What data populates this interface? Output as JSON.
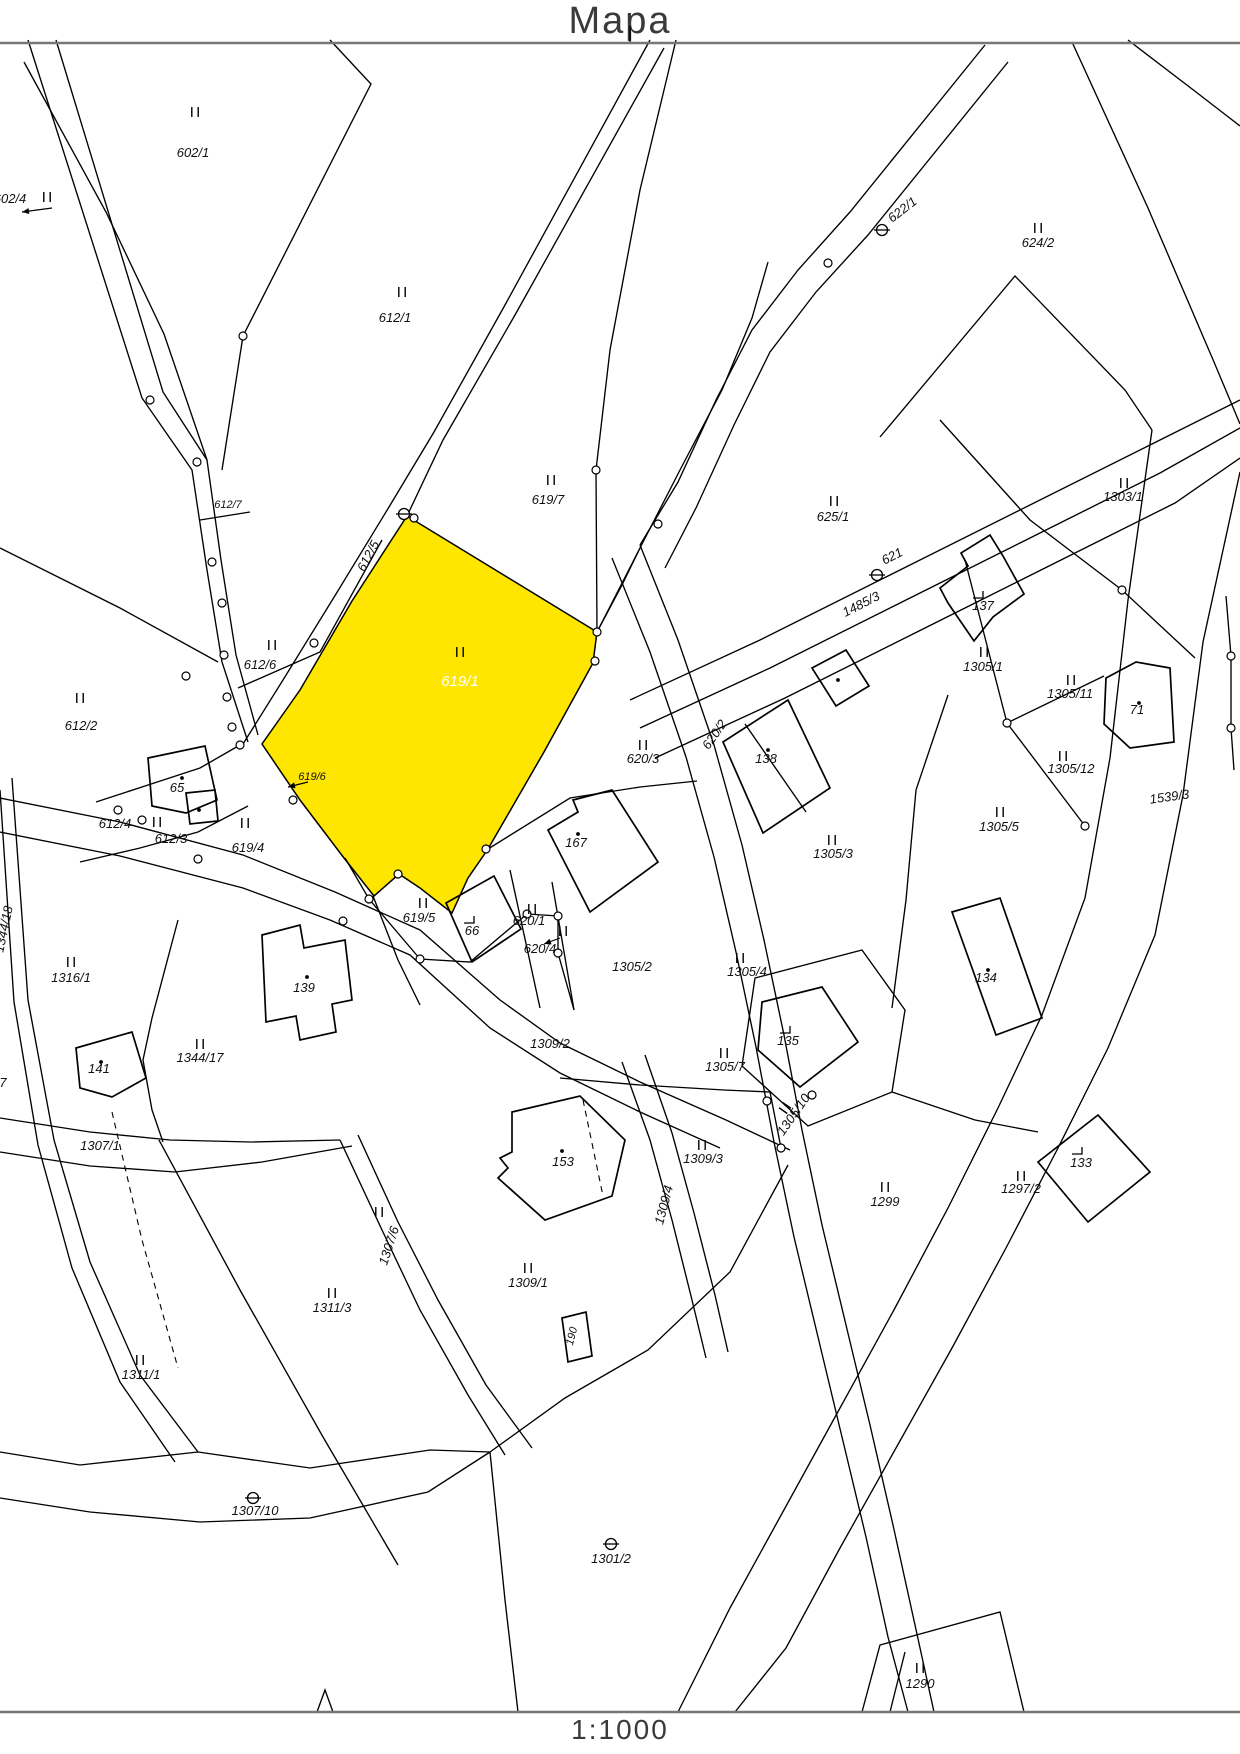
{
  "title": "Mapa",
  "scale": "1:1000",
  "map": {
    "width": 1240,
    "height": 1754,
    "highlighted_parcel": "619/1",
    "colors": {
      "highlight": "#ffe600",
      "line": "#000000",
      "rule": "#777777",
      "label": "#111111"
    },
    "highlight_points": "407,516 597,632 593,663 544,752 488,849 468,878 452,913 420,888 399,874 374,896 344,858 300,800 262,744 300,690 352,601",
    "labels": [
      {
        "t": "602/4",
        "x": 10,
        "y": 203
      },
      {
        "t": "602/1",
        "x": 193,
        "y": 157
      },
      {
        "t": "612/1",
        "x": 395,
        "y": 322
      },
      {
        "t": "622/1",
        "x": 905,
        "y": 213,
        "r": -38
      },
      {
        "t": "624/2",
        "x": 1038,
        "y": 247
      },
      {
        "t": "612/7",
        "x": 228,
        "y": 508,
        "s": 11
      },
      {
        "t": "619/7",
        "x": 548,
        "y": 504
      },
      {
        "t": "625/1",
        "x": 833,
        "y": 521
      },
      {
        "t": "1303/1",
        "x": 1123,
        "y": 501
      },
      {
        "t": "612/5",
        "x": 372,
        "y": 558,
        "r": -62
      },
      {
        "t": "619/1",
        "x": 460,
        "y": 686,
        "s": 15,
        "c": "#ffffff"
      },
      {
        "t": "621",
        "x": 894,
        "y": 560,
        "r": -27
      },
      {
        "t": "1485/3",
        "x": 863,
        "y": 608,
        "r": -27
      },
      {
        "t": "137",
        "x": 983,
        "y": 610
      },
      {
        "t": "1305/1",
        "x": 983,
        "y": 671
      },
      {
        "t": "1305/11",
        "x": 1070,
        "y": 698
      },
      {
        "t": "71",
        "x": 1137,
        "y": 714
      },
      {
        "t": "612/6",
        "x": 260,
        "y": 669
      },
      {
        "t": "612/2",
        "x": 81,
        "y": 730
      },
      {
        "t": "620/3",
        "x": 643,
        "y": 763
      },
      {
        "t": "620/2",
        "x": 718,
        "y": 737,
        "r": -55
      },
      {
        "t": "138",
        "x": 766,
        "y": 763
      },
      {
        "t": "1305/12",
        "x": 1071,
        "y": 773
      },
      {
        "t": "1539/3",
        "x": 1170,
        "y": 801,
        "r": -8
      },
      {
        "t": "65",
        "x": 177,
        "y": 792
      },
      {
        "t": "619/6",
        "x": 312,
        "y": 780,
        "s": 11
      },
      {
        "t": "612/4",
        "x": 115,
        "y": 828
      },
      {
        "t": "612/3",
        "x": 171,
        "y": 843
      },
      {
        "t": "619/4",
        "x": 248,
        "y": 852
      },
      {
        "t": "167",
        "x": 576,
        "y": 847
      },
      {
        "t": "1305/3",
        "x": 833,
        "y": 858
      },
      {
        "t": "1305/5",
        "x": 999,
        "y": 831
      },
      {
        "t": "1316/1",
        "x": 71,
        "y": 982
      },
      {
        "t": "619/5",
        "x": 419,
        "y": 922
      },
      {
        "t": "66",
        "x": 472,
        "y": 935
      },
      {
        "t": "620/1",
        "x": 529,
        "y": 925
      },
      {
        "t": "620/4",
        "x": 540,
        "y": 953
      },
      {
        "t": "1305/2",
        "x": 632,
        "y": 971
      },
      {
        "t": "1305/4",
        "x": 747,
        "y": 976
      },
      {
        "t": "139",
        "x": 304,
        "y": 992
      },
      {
        "t": "134",
        "x": 986,
        "y": 982
      },
      {
        "t": "1344/17",
        "x": 200,
        "y": 1062
      },
      {
        "t": "141",
        "x": 99,
        "y": 1073
      },
      {
        "t": "1344/18",
        "x": 8,
        "y": 930,
        "r": -78
      },
      {
        "t": "1307/1",
        "x": 100,
        "y": 1150
      },
      {
        "t": "1309/2",
        "x": 550,
        "y": 1048
      },
      {
        "t": "1305/7",
        "x": 725,
        "y": 1071
      },
      {
        "t": "135",
        "x": 788,
        "y": 1045
      },
      {
        "t": "1305/10",
        "x": 797,
        "y": 1117,
        "r": -55
      },
      {
        "t": "153",
        "x": 563,
        "y": 1166
      },
      {
        "t": "1309/3",
        "x": 703,
        "y": 1163
      },
      {
        "t": "133",
        "x": 1081,
        "y": 1167
      },
      {
        "t": "1297/2",
        "x": 1021,
        "y": 1193
      },
      {
        "t": "1299",
        "x": 885,
        "y": 1206
      },
      {
        "t": "1307/6",
        "x": 393,
        "y": 1247,
        "r": -72
      },
      {
        "t": "1309/4",
        "x": 668,
        "y": 1206,
        "r": -75
      },
      {
        "t": "1309/1",
        "x": 528,
        "y": 1287
      },
      {
        "t": "1311/3",
        "x": 332,
        "y": 1312
      },
      {
        "t": "1311/1",
        "x": 141,
        "y": 1379
      },
      {
        "t": "190",
        "x": 575,
        "y": 1337,
        "r": -75,
        "s": 11
      },
      {
        "t": "1307/10",
        "x": 255,
        "y": 1515
      },
      {
        "t": "1301/2",
        "x": 611,
        "y": 1563
      },
      {
        "t": "1290",
        "x": 920,
        "y": 1688
      },
      {
        "t": "7",
        "x": 3,
        "y": 1087
      }
    ],
    "landuse_marks": [
      {
        "x": 195,
        "y": 112
      },
      {
        "x": 47,
        "y": 197
      },
      {
        "x": 402,
        "y": 292
      },
      {
        "x": 1038,
        "y": 228
      },
      {
        "x": 551,
        "y": 480
      },
      {
        "x": 834,
        "y": 501
      },
      {
        "x": 1124,
        "y": 483
      },
      {
        "x": 272,
        "y": 645
      },
      {
        "x": 80,
        "y": 698
      },
      {
        "x": 460,
        "y": 652
      },
      {
        "x": 643,
        "y": 745
      },
      {
        "x": 984,
        "y": 652
      },
      {
        "x": 1071,
        "y": 680
      },
      {
        "x": 1063,
        "y": 756
      },
      {
        "x": 157,
        "y": 822
      },
      {
        "x": 245,
        "y": 823
      },
      {
        "x": 832,
        "y": 840
      },
      {
        "x": 1000,
        "y": 812
      },
      {
        "x": 71,
        "y": 962
      },
      {
        "x": 423,
        "y": 903
      },
      {
        "x": 532,
        "y": 909
      },
      {
        "x": 563,
        "y": 931
      },
      {
        "x": 740,
        "y": 958
      },
      {
        "x": 200,
        "y": 1044
      },
      {
        "x": 724,
        "y": 1053
      },
      {
        "x": 702,
        "y": 1145
      },
      {
        "x": 1021,
        "y": 1176
      },
      {
        "x": 885,
        "y": 1187
      },
      {
        "x": 528,
        "y": 1268
      },
      {
        "x": 332,
        "y": 1293
      },
      {
        "x": 140,
        "y": 1360
      },
      {
        "x": 379,
        "y": 1212
      },
      {
        "x": 920,
        "y": 1668
      },
      {
        "x": 785,
        "y": 1108,
        "r": -55
      }
    ],
    "survey_marks": [
      [
        404,
        514
      ],
      [
        882,
        230
      ],
      [
        877,
        575
      ],
      [
        253,
        1498
      ],
      [
        611,
        1544
      ]
    ],
    "boundary_points": [
      [
        150,
        400
      ],
      [
        197,
        462
      ],
      [
        212,
        562
      ],
      [
        224,
        655
      ],
      [
        243,
        336
      ],
      [
        596,
        470
      ],
      [
        658,
        524
      ],
      [
        597,
        632
      ],
      [
        595,
        661
      ],
      [
        486,
        849
      ],
      [
        398,
        874
      ],
      [
        369,
        899
      ],
      [
        420,
        959
      ],
      [
        527,
        914
      ],
      [
        558,
        916
      ],
      [
        558,
        953
      ],
      [
        343,
        921
      ],
      [
        198,
        859
      ],
      [
        222,
        603
      ],
      [
        227,
        697
      ],
      [
        232,
        727
      ],
      [
        240,
        745
      ],
      [
        293,
        800
      ],
      [
        314,
        643
      ],
      [
        186,
        676
      ],
      [
        828,
        263
      ],
      [
        1122,
        590
      ],
      [
        1231,
        656
      ],
      [
        1231,
        728
      ],
      [
        1007,
        723
      ],
      [
        1085,
        826
      ],
      [
        767,
        1101
      ],
      [
        812,
        1095
      ],
      [
        781,
        1148
      ],
      [
        118,
        810
      ],
      [
        142,
        820
      ],
      [
        414,
        518
      ]
    ],
    "building_dots": [
      [
        182,
        778
      ],
      [
        199,
        810
      ],
      [
        768,
        750
      ],
      [
        838,
        680
      ],
      [
        578,
        834
      ],
      [
        1139,
        703
      ],
      [
        307,
        977
      ],
      [
        101,
        1062
      ],
      [
        562,
        1151
      ],
      [
        988,
        970
      ]
    ],
    "building_marks": [
      [
        979,
        596
      ],
      [
        470,
        921
      ],
      [
        786,
        1031
      ],
      [
        1078,
        1152
      ]
    ],
    "arrows": [
      [
        52,
        208,
        22,
        212
      ],
      [
        308,
        782,
        288,
        787
      ],
      [
        560,
        938,
        544,
        944
      ]
    ],
    "lines": [
      "M630,26 L630,43",
      "M28,40 L142,398 L192,470 L207,570 L222,662 L248,742",
      "M56,40 L163,392 L207,460 L221,560 L236,655 L258,735",
      "M24,62 L106,212 L164,334 L207,460",
      "M330,40 L371,84 L243,336 L222,470",
      "M650,40 L505,305 L434,432 L389,507 L336,594 L283,680 L243,744",
      "M664,48 L515,315 L443,440 L407,516",
      "M676,40 L640,190 L610,350 L596,470 L597,632",
      "M597,632 L640,548 L680,470 L722,390 L752,318 L768,262",
      "M985,45 L850,212 L798,270 L752,330 L716,400 L678,482 L640,545",
      "M1008,62 L868,235 L816,292 L770,352 L734,425 L696,508 L665,568",
      "M640,545 L678,640 L714,745 L742,845 L764,940 L784,1035 L802,1130 L822,1225 L846,1325 L870,1425 L893,1525 L915,1625 L934,1712",
      "M612,558 L650,652 L686,757 L714,857 L736,952 L756,1047 L774,1142 L794,1237 L818,1337 L842,1437 L866,1537 L888,1637 L908,1712",
      "M597,632 L622,585 L640,548",
      "M630,700 L760,640 L890,575 L1020,510 L1150,445 L1240,400",
      "M640,728 L770,668 L900,603 L1030,538 L1160,473 L1240,428",
      "M655,758 L785,698 L915,633 L1045,568 L1175,503 L1240,458",
      "M1152,430 L1128,600 L1110,758 L1085,898 L1042,1015 L998,1108 L948,1208 L895,1308 L840,1408 L785,1508 L730,1608 L678,1712",
      "M1240,472 L1203,642 L1183,795 L1155,935 L1108,1048 L1058,1148 L1006,1248 L952,1348 L896,1448 L840,1548 L786,1648 L735,1712",
      "M880,437 L1015,276 L1125,390 L1152,430",
      "M940,420 L1030,520 L1122,590 L1195,658",
      "M1072,42 L1148,208 L1214,362 L1240,424",
      "M1128,40 L1196,92 L1240,126",
      "M1226,596 L1231,656 L1231,728 L1234,770",
      "M0,798 L120,822 L243,855 L335,892 L420,930 L500,1000 L560,1043 L640,1082 L726,1120 L790,1150",
      "M0,832 L120,856 L243,888 L330,920 L410,955 L490,1028 L560,1073 L640,1112 L720,1148",
      "M0,548 L120,608 L218,662",
      "M238,688 L320,652 L382,540",
      "M96,802 L145,786 L200,768 L240,745",
      "M80,862 L140,848 L198,832 L248,806",
      "M178,920 L152,1018 L143,1060 L152,1110 L163,1142",
      "M159,1140 L240,1290 L323,1437 L398,1565",
      "M12,778 L28,1000 L54,1140 L90,1262 L140,1375 L198,1452",
      "M0,790 L14,1002 L38,1145 L72,1268 L120,1382 L175,1462",
      "M0,1452 L80,1465 L198,1452 L310,1468 L430,1450 L490,1452 L565,1398 L648,1350 L730,1272 L788,1165",
      "M0,1498 L90,1512 L200,1522 L310,1518 L428,1492 L490,1452",
      "M490,1452 L505,1600 L518,1712",
      "M622,1062 L650,1140 L672,1220 L692,1300 L706,1358",
      "M645,1055 L672,1133 L694,1213 L715,1295 L728,1352",
      "M560,1078 L640,1085 L724,1090 L770,1092 L781,1148",
      "M755,978 L862,950 L905,1010 L892,1092 L808,1126 L742,1066 Z",
      "M948,695 L916,790 L906,900 L892,1008",
      "M892,1092 L975,1120 L1038,1132",
      "M340,1140 L382,1230 L420,1310 L468,1395 L505,1455",
      "M358,1135 L398,1222 L438,1300 L486,1385 L532,1448",
      "M0,1118 L90,1132 L170,1140 L250,1142 L340,1140",
      "M0,1152 L90,1166 L175,1172 L262,1162 L352,1146",
      "M200,520 L250,512",
      "M510,870 L540,1008",
      "M552,882 L574,1010",
      "M488,849 L570,798 L640,787 L697,781",
      "M965,560 L1007,723",
      "M1007,723 L1085,826",
      "M1007,723 L1104,676",
      "M745,724 L806,812",
      "M862,1712 L880,1645 L1000,1612 L1024,1712",
      "M890,1712 L905,1652",
      "M317,1712 L325,1690 L333,1712",
      "M373,896 L398,960 L420,1005",
      "M345,858 L369,899 L420,959 L470,962 L527,914",
      "M527,914 L558,916 L558,953 L574,1010"
    ],
    "dashed_lines": [
      "M1106,678 L1104,724",
      "M583,1100 L603,1196",
      "M112,1112 L142,1240 L178,1368"
    ],
    "buildings": [
      "M148,758 L205,746 L217,800 L186,813 L152,806 Z",
      "M186,793 L215,790 L218,821 L190,824 Z",
      "M446,903 L494,876 L521,929 L472,962 Z",
      "M548,830 L578,812 L573,800 L612,790 L658,862 L590,912 Z",
      "M723,742 L788,700 L830,788 L763,833 Z",
      "M812,668 L846,650 L869,686 L836,706 Z",
      "M940,588 L968,566 L961,553 L990,535 L1003,556 L1024,594 L993,617 L974,641 L948,603 Z",
      "M1106,678 L1136,662 L1170,668 L1174,742 L1130,748 L1104,724 Z",
      "M952,912 L1000,898 L1042,1018 L996,1035 Z",
      "M762,1002 L822,987 L858,1042 L800,1087 L758,1050 Z",
      "M1038,1162 L1098,1115 L1150,1172 L1088,1222 Z",
      "M262,935 L300,925 L304,948 L345,940 L352,1000 L332,1004 L336,1032 L300,1040 L296,1016 L266,1022 Z",
      "M76,1048 L132,1032 L146,1078 L112,1097 L80,1088 Z",
      "M512,1112 L580,1096 L625,1140 L612,1196 L545,1220 L498,1178 L508,1168 L500,1158 L512,1152 Z",
      "M562,1318 L586,1312 L592,1356 L568,1362 Z"
    ]
  }
}
